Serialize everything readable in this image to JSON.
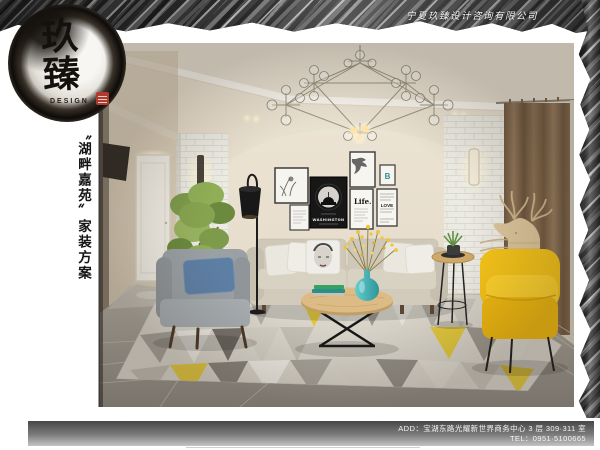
{
  "brand": {
    "company_name": "宁夏玖臻设计咨询有限公司",
    "logo_text": "玖臻",
    "logo_subtext": "DESIGN"
  },
  "project": {
    "title": "〝湖畔嘉苑〞家装方案"
  },
  "contact": {
    "address_line": "ADD：宝湖东路光耀新世界商务中心 3 层 309·311 室",
    "tel_line": "TEL：0951·5100665"
  },
  "artworks": {
    "life_print": "Life.",
    "washington_poster": "WASHINGTON",
    "love_print": "LOVE",
    "monogram_print": "B"
  },
  "palette": {
    "accent_yellow": "#f6c417",
    "vase_teal": "#3fb0b5",
    "curtain_brown": "#8a6e4e",
    "wall_beige": "#e4dbca",
    "seal_red": "#b03a2e",
    "ink_black": "#1c1814"
  }
}
